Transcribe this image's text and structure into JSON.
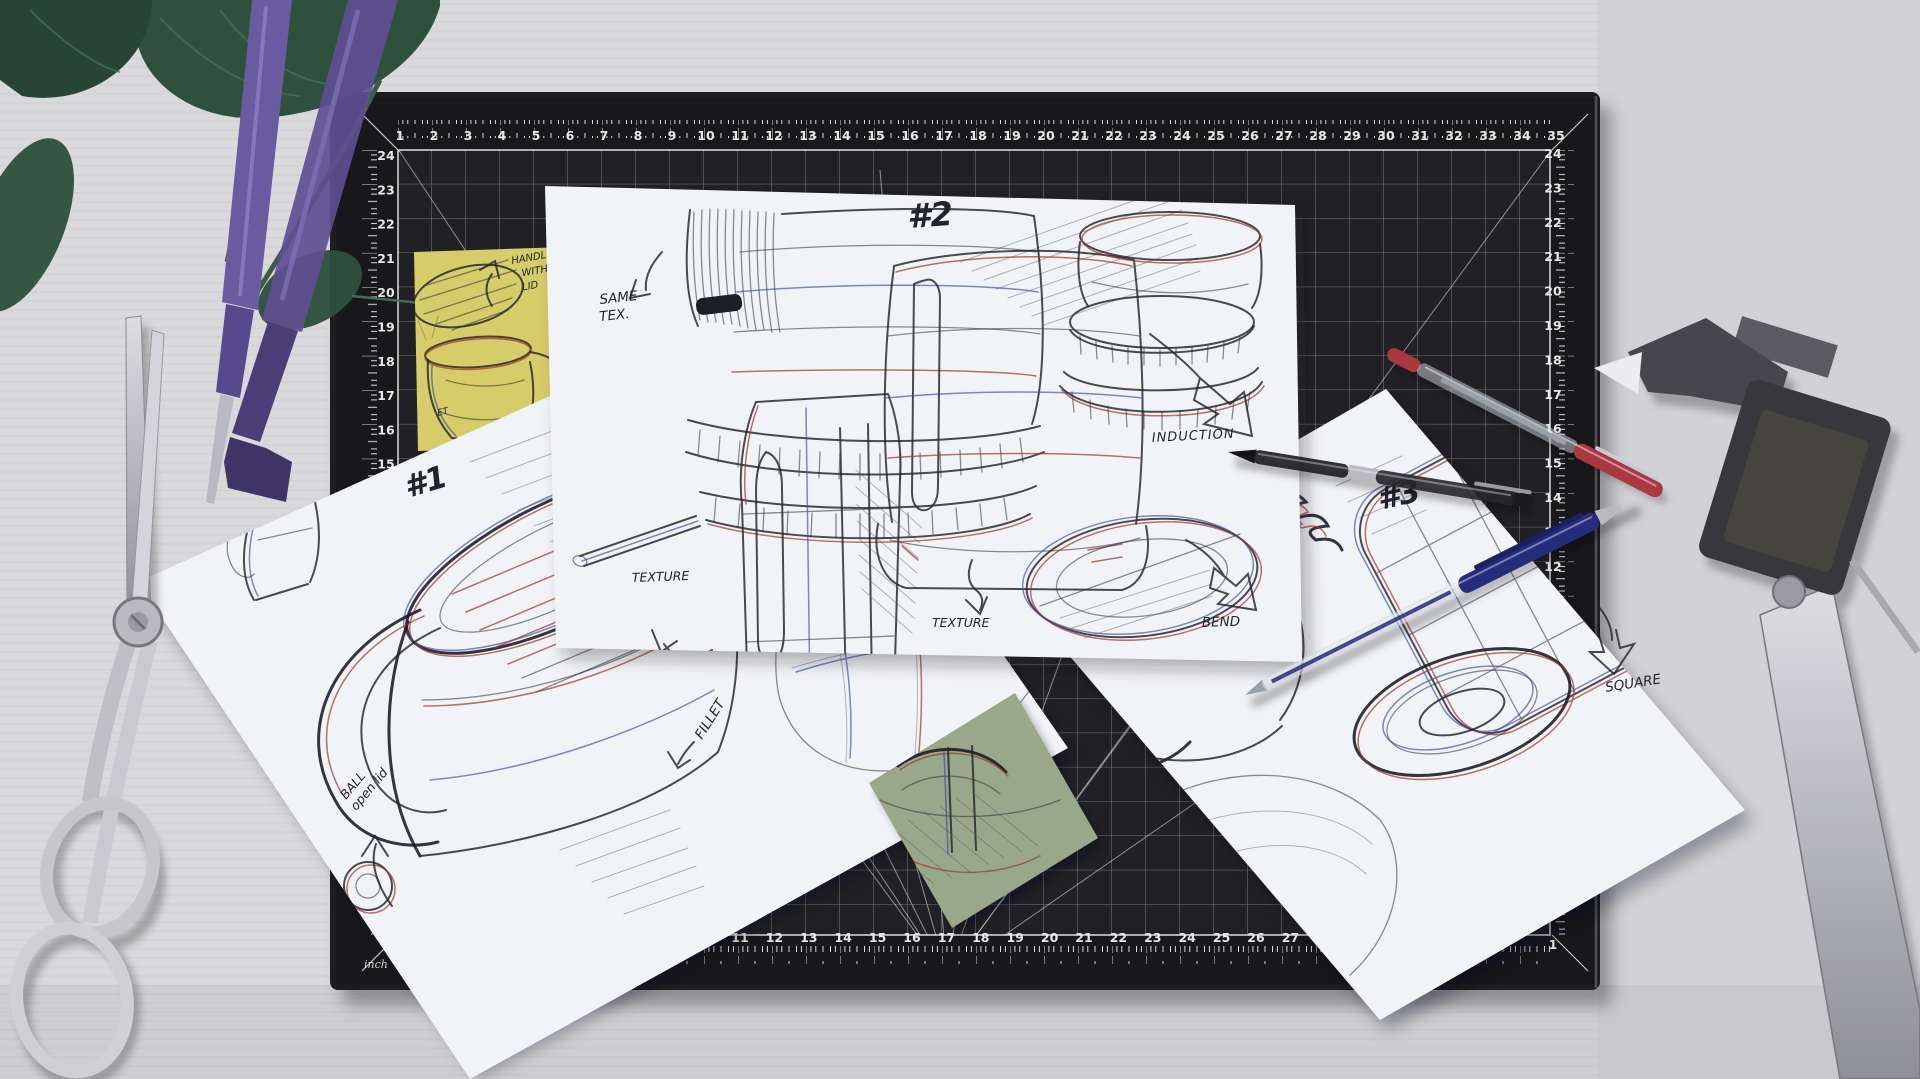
{
  "colors": {
    "desk": "#d9d9db",
    "desk_right": "#d0d0d4",
    "mat": "#1d1d20",
    "mat_strip": "#18181b",
    "mat_grid_area": "#212125",
    "grid_line": "#ffffff",
    "paper": "#f2f3f7",
    "yellow_note": "#d6cc69",
    "green_note": "#99a78a",
    "blue_note": "#a9b6d8",
    "ink": "#23232b",
    "ink_red": "#9e3a31",
    "ink_blue": "#3b49a8",
    "pen_red": "#a93840",
    "pen_navy": "#272b7e",
    "caliper_body": "#37373c",
    "screwdriver_purple": "#5e4f92",
    "scissors_steel": "#c6c6cb",
    "plant_green": "#30503e"
  },
  "mat": {
    "unit_label": "inch",
    "top_numbers": [
      "1",
      "2",
      "3",
      "4",
      "5",
      "6",
      "7",
      "8",
      "9",
      "10",
      "11",
      "12",
      "13",
      "14",
      "15",
      "16",
      "17",
      "18",
      "19",
      "20",
      "21",
      "22",
      "23",
      "24",
      "25",
      "26",
      "27",
      "28",
      "29",
      "30",
      "31",
      "32",
      "33",
      "34",
      "35"
    ],
    "left_numbers": [
      "24",
      "23",
      "22",
      "21",
      "20",
      "19",
      "18",
      "17",
      "16",
      "15",
      "14",
      "13",
      "12",
      "11",
      "10",
      "9",
      "8",
      "7",
      "6",
      "5",
      "4",
      "3",
      "2",
      "1"
    ],
    "right_numbers": [
      "24",
      "23",
      "22",
      "21",
      "20",
      "19",
      "18",
      "17",
      "16",
      "15",
      "14",
      "13",
      "12",
      "11",
      "10",
      "9",
      "8",
      "7",
      "6",
      "5",
      "4",
      "3",
      "2",
      "1"
    ],
    "bottom_numbers": [
      "1",
      "2",
      "3",
      "4",
      "5",
      "6",
      "7",
      "8",
      "9",
      "10",
      "11",
      "12",
      "13",
      "14",
      "15",
      "16",
      "17",
      "18",
      "19",
      "20",
      "21",
      "22",
      "23",
      "24",
      "25",
      "26",
      "27"
    ]
  },
  "papers": {
    "paper1": {
      "label": "#1",
      "note_ball_line1": "BALL",
      "note_ball_line2": "open lid",
      "note_fillet": "FILLET"
    },
    "paper2": {
      "label": "#2",
      "note_same_line1": "SAME",
      "note_same_line2": "TEX.",
      "note_texture_left": "TEXTURE",
      "note_texture_bottom": "TEXTURE",
      "note_induction": "INDUCTION",
      "note_bend": "BEND"
    },
    "paper3": {
      "label": "#3",
      "note_square": "SQUARE"
    },
    "yellow_note": {
      "line1": "HANDLE",
      "line2": "WITH",
      "line3": "LID",
      "partial_label": "ET"
    }
  }
}
